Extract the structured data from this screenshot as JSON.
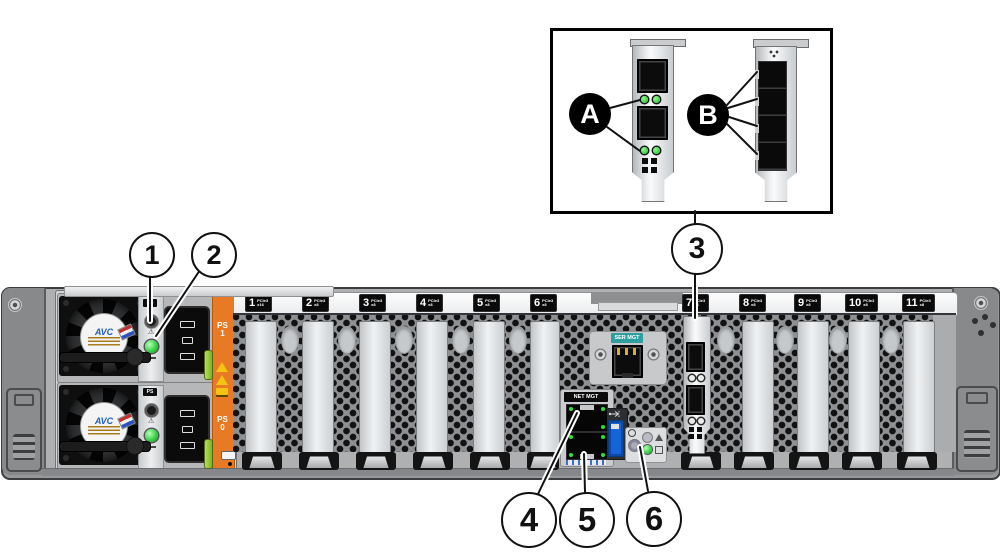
{
  "callouts": {
    "c1": "1",
    "c2": "2",
    "c3": "3",
    "c4": "4",
    "c5": "5",
    "c6": "6",
    "ca": "A",
    "cb": "B"
  },
  "chassis": {
    "pcie_slots": [
      {
        "num": "1",
        "gen": "PCIe3",
        "bus": "x16"
      },
      {
        "num": "2",
        "gen": "PCIe3",
        "bus": "x8"
      },
      {
        "num": "3",
        "gen": "PCIe3",
        "bus": "x8"
      },
      {
        "num": "4",
        "gen": "PCIe3",
        "bus": "x8"
      },
      {
        "num": "5",
        "gen": "PCIe3",
        "bus": "x8"
      },
      {
        "num": "6",
        "gen": "PCIe3",
        "bus": "x8"
      },
      {
        "num": "7",
        "gen": "PCIe3",
        "bus": "x8"
      },
      {
        "num": "8",
        "gen": "PCIe3",
        "bus": "x8"
      },
      {
        "num": "9",
        "gen": "PCIe3",
        "bus": "x8"
      },
      {
        "num": "10",
        "gen": "PCIe3",
        "bus": "x8"
      },
      {
        "num": "11",
        "gen": "PCIe3",
        "bus": "x8"
      }
    ],
    "ser_mgt_label": "SER MGT",
    "net_mgt_label": "NET MGT",
    "psu": {
      "fan_brand": "AVC",
      "ps_chip": "PS",
      "ps1_top": "PS",
      "ps1_num": "1",
      "ps0_top": "PS",
      "ps0_num": "0"
    }
  },
  "colors": {
    "accent_orange": "#E87A26",
    "ser_mgt_teal": "#2F9E9E",
    "led_green": "#2ECC40",
    "usb_blue": "#1565D8",
    "chassis_gray": "#AEB0B2",
    "callout_black": "#000000"
  }
}
